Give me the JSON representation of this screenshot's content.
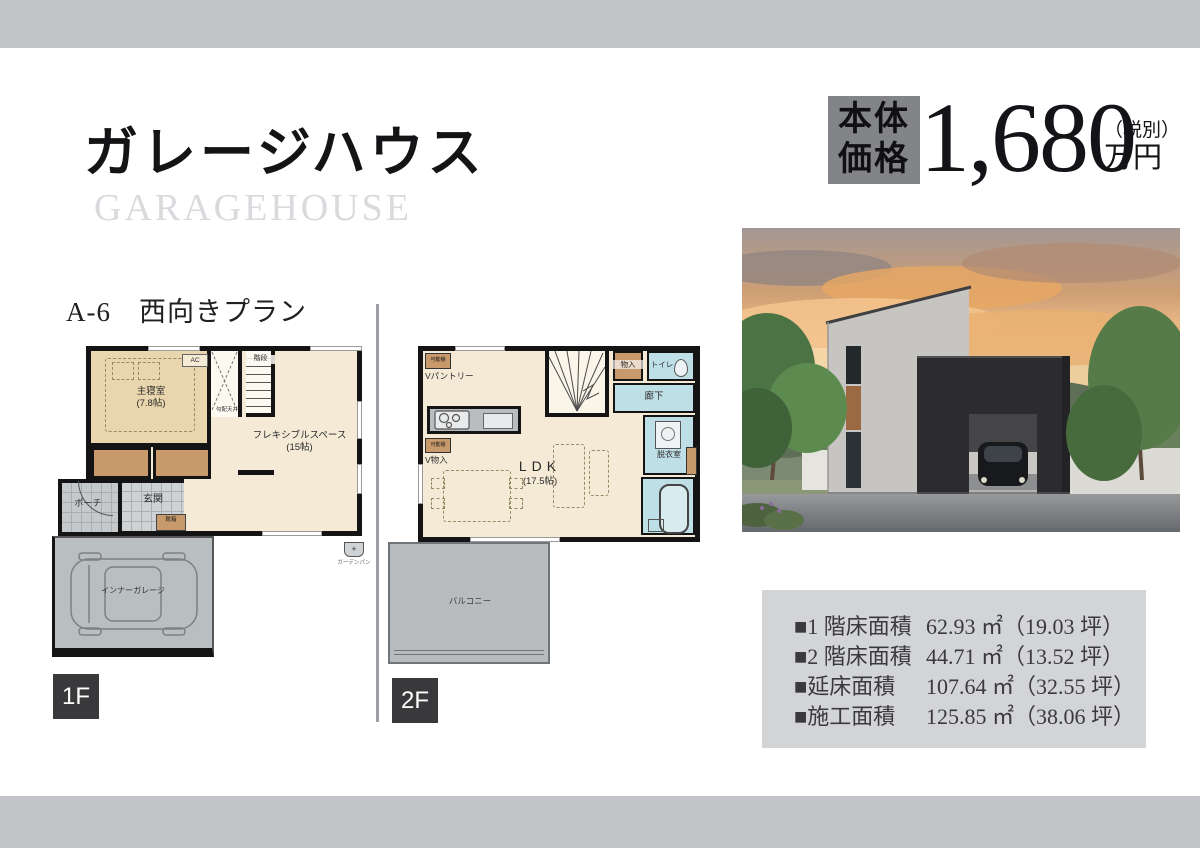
{
  "header": {
    "title": "ガレージハウス",
    "subtitle": "GARAGEHOUSE"
  },
  "price": {
    "label_line1": "本体",
    "label_line2": "価格",
    "amount": "1,680",
    "tax_note": "（税別）",
    "unit": "万円"
  },
  "plan": {
    "name": "A-6　西向きプラン",
    "floor1_badge": "1F",
    "floor2_badge": "2F"
  },
  "floor1": {
    "master_bedroom": "主寝室",
    "master_bedroom_size": "(7.8帖)",
    "ac": "AC",
    "sloped_ceiling": "勾配天井",
    "stairs": "階段",
    "flex_space": "フレキシブルスペース",
    "flex_space_size": "(15帖)",
    "porch": "ポーチ",
    "entrance": "玄関",
    "shoe_box": "靴箱",
    "garage": "インナーガレージ",
    "garden_pan": "ガーデンパン",
    "garden_pan_mark": "+"
  },
  "floor2": {
    "pantry": "Vパントリー",
    "movable_shelf": "可動棚",
    "storage_left": "V物入",
    "storage_top": "物入",
    "toilet": "トイレ",
    "hallway": "廊下",
    "dressing_room": "脱衣室",
    "ldk": "LDK",
    "ldk_size": "(17.5帖)",
    "balcony": "バルコニー"
  },
  "areas": {
    "items": [
      {
        "label": "■1 階床面積",
        "value": "62.93 ㎡（19.03 坪）"
      },
      {
        "label": "■2 階床面積",
        "value": "44.71 ㎡（13.52 坪）"
      },
      {
        "label": "■延床面積",
        "value": "107.64 ㎡（32.55 坪）"
      },
      {
        "label": "■施工面積",
        "value": "125.85 ㎡（38.06 坪）"
      }
    ]
  },
  "colors": {
    "bar_gray": "#c3c5c9",
    "price_box_gray": "#828487",
    "badge_dark": "#39393c",
    "area_box_gray": "#d3d4d6",
    "room_beige": "#f4ead6",
    "bedroom_tan": "#e9d6ae",
    "closet_brown": "#c8996a",
    "wet_area_blue": "#bfdfe7",
    "outdoor_gray": "#b9bec1"
  }
}
